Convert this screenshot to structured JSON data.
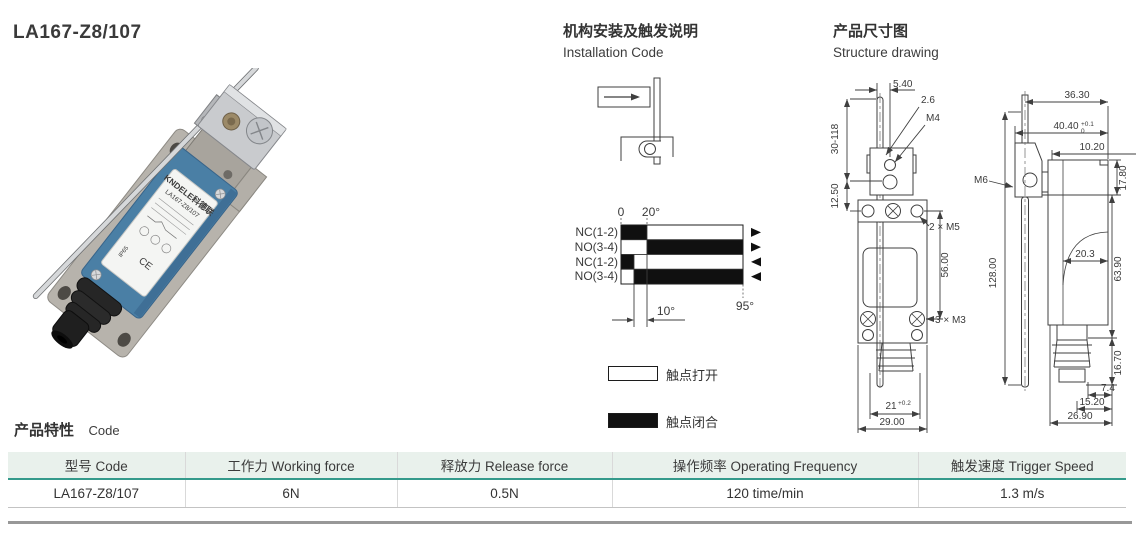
{
  "title": "LA167-Z8/107",
  "photo": {
    "brand": "KNDELE科德联",
    "model": "LA167-Z8/107",
    "ip": "IP65",
    "ce": "CE"
  },
  "installation": {
    "title_zh": "机构安装及触发说明",
    "title_en": "Installation Code"
  },
  "timing": {
    "tick0": "0",
    "tick20": "20°",
    "tick95": "95°",
    "dim10": "10°",
    "rows": [
      {
        "label": "NC(1-2)",
        "closed_deg": [
          0,
          20
        ],
        "open_deg": [
          20,
          95
        ],
        "direction": "forward"
      },
      {
        "label": "NO(3-4)",
        "open_deg": [
          0,
          20
        ],
        "closed_deg": [
          20,
          95
        ],
        "direction": "forward"
      },
      {
        "label": "NC(1-2)",
        "closed_deg": [
          0,
          10
        ],
        "open_deg": [
          10,
          95
        ],
        "direction": "return"
      },
      {
        "label": "NO(3-4)",
        "open_deg": [
          0,
          10
        ],
        "closed_deg": [
          10,
          95
        ],
        "direction": "return"
      }
    ],
    "legend_open": "触点打开",
    "legend_closed": "触点闭合"
  },
  "structure": {
    "title_zh": "产品尺寸图",
    "title_en": "Structure drawing",
    "front": {
      "rod_offset": "5.40",
      "rod_dia": "2.6",
      "m4": "M4",
      "lever_range": "30-118",
      "head_depth": "12.50",
      "m5": "2 × M5",
      "mount_spacing": "56.00",
      "m3": "3 × M3",
      "slot_width": "21",
      "slot_tol": "+0.2",
      "base_width": "29.00"
    },
    "side": {
      "top_width": "36.30",
      "overall_width": "40.40",
      "overall_tol_top": "+0.1",
      "overall_tol_bottom": "0",
      "offset": "10.20",
      "head_height": "17.80",
      "m6": "M6",
      "body_width": "20.3",
      "body_height": "63.90",
      "lever_length": "128.00",
      "bellows_height": "16.70",
      "tip_a": "7.4",
      "tip_b": "15.20",
      "tip_c": "26.90"
    }
  },
  "characteristics": {
    "title_zh": "产品特性",
    "title_en": "Code",
    "headers": [
      "型号 Code",
      "工作力 Working force",
      "释放力 Release force",
      "操作频率 Operating Frequency",
      "触发速度 Trigger Speed"
    ],
    "row": [
      "LA167-Z8/107",
      "6N",
      "0.5N",
      "120 time/min",
      "1.3 m/s"
    ]
  },
  "colors": {
    "accent_green": "#349a8b",
    "header_bg": "#e9f1ec",
    "line": "#3f3f3f"
  }
}
